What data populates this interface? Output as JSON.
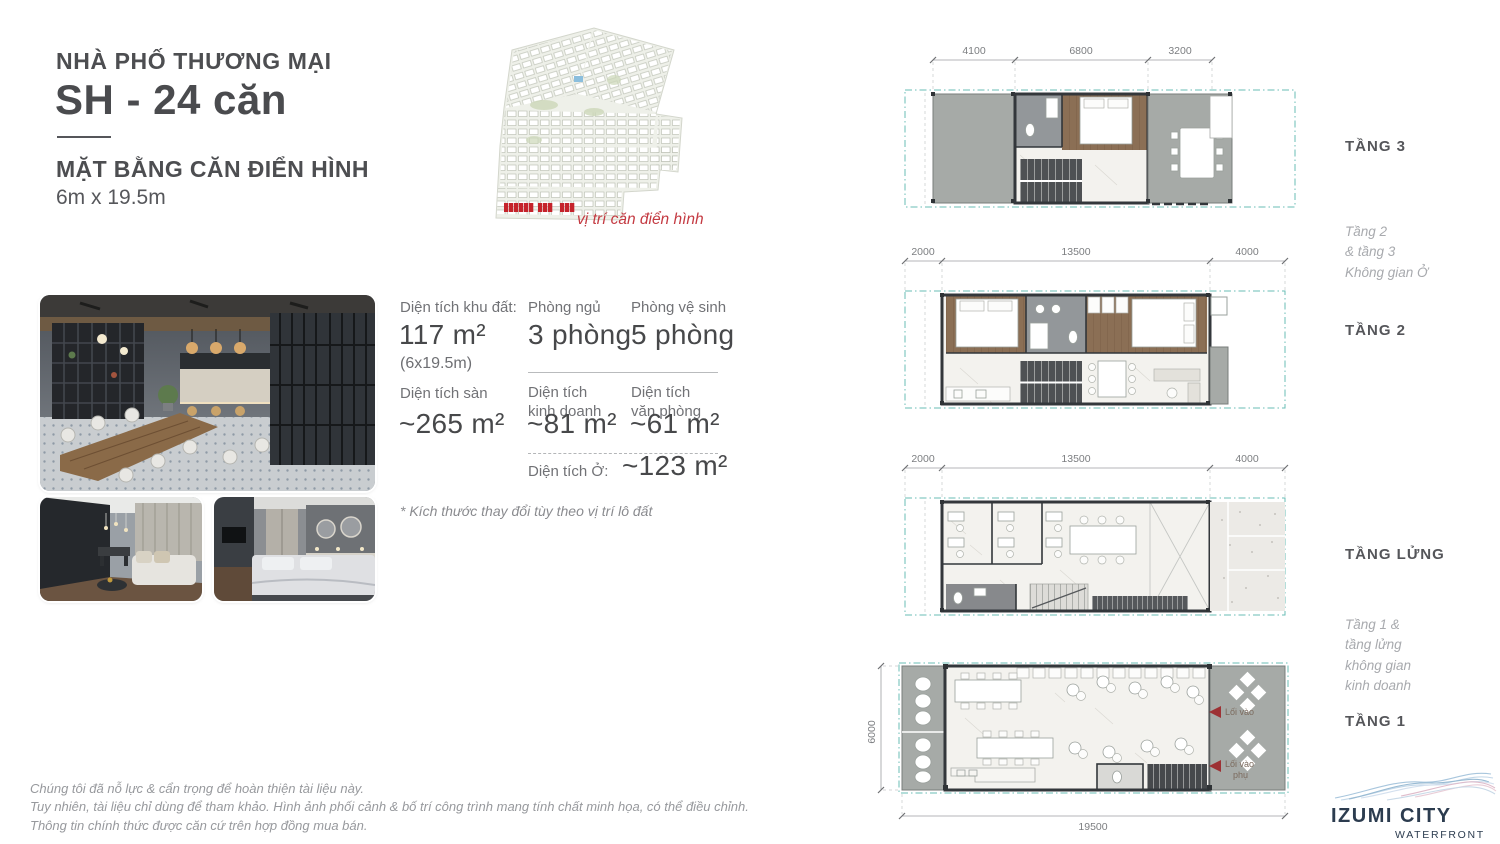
{
  "header": {
    "category": "NHÀ PHỐ THƯƠNG MẠI",
    "title": "SH - 24 căn",
    "plan_type": "MẶT BẰNG CĂN ĐIỂN HÌNH",
    "plan_size": "6m x 19.5m"
  },
  "site_plan": {
    "caption": "vị trí căn điển hình"
  },
  "stats": {
    "land": {
      "label": "Diện tích khu đất:",
      "value": "117 m²",
      "sub": "(6x19.5m)"
    },
    "bedrooms": {
      "label": "Phòng ngủ",
      "value": "3 phòng"
    },
    "bathrooms": {
      "label": "Phòng vệ sinh",
      "value": "5 phòng"
    },
    "floor_area": {
      "label": "Diện tích sàn",
      "value": "~265 m²"
    },
    "business_area": {
      "label_1": "Diện tích",
      "label_2": "kinh doanh",
      "value": "~81 m²"
    },
    "office_area": {
      "label_1": "Diện tích",
      "label_2": "văn phòng",
      "value": "~61 m²"
    },
    "living_area": {
      "label": "Diện tích Ở:",
      "value": "~123 m²"
    },
    "note": "* Kích thước thay đổi tùy theo vị trí lô đất"
  },
  "floors": {
    "tang3": {
      "label": "TẦNG 3",
      "dims": [
        "4100",
        "6800",
        "3200"
      ]
    },
    "tang2": {
      "label": "TẦNG 2",
      "dims": [
        "2000",
        "13500",
        "4000"
      ]
    },
    "tang_lung": {
      "label": "TẦNG LỬNG",
      "dims": [
        "2000",
        "13500",
        "4000"
      ]
    },
    "tang1": {
      "label": "TẦNG 1",
      "dim_width": "19500",
      "dim_depth": "6000",
      "entrance_main": "Lối vào",
      "entrance_side": [
        "Lối vào",
        "phụ"
      ]
    }
  },
  "floor_notes": {
    "upper": [
      "Tầng 2",
      "& tầng 3",
      "Không gian Ở"
    ],
    "lower": [
      "Tầng 1 &",
      "tầng lửng",
      "không gian",
      "kinh doanh"
    ]
  },
  "footer": {
    "line1": "Chúng tôi đã nỗ lực & cẩn trọng để hoàn thiện tài liệu này.",
    "line2": "Tuy nhiên, tài liệu chỉ dùng để tham khảo. Hình ảnh phối cảnh & bố trí công trình mang tính chất minh họa, có thể điều chỉnh.",
    "line3": "Thông tin chính thức được căn cứ trên hợp đồng mua bán."
  },
  "logo": {
    "name": "IZUMI CITY",
    "tagline_1": "WATERFRONT",
    "tagline_2": "COMMUNITY"
  },
  "colors": {
    "accent_red": "#c5232b",
    "boundary_teal": "#68bcb6",
    "text_dark": "#4d4e50",
    "text_gray": "#97999d"
  }
}
